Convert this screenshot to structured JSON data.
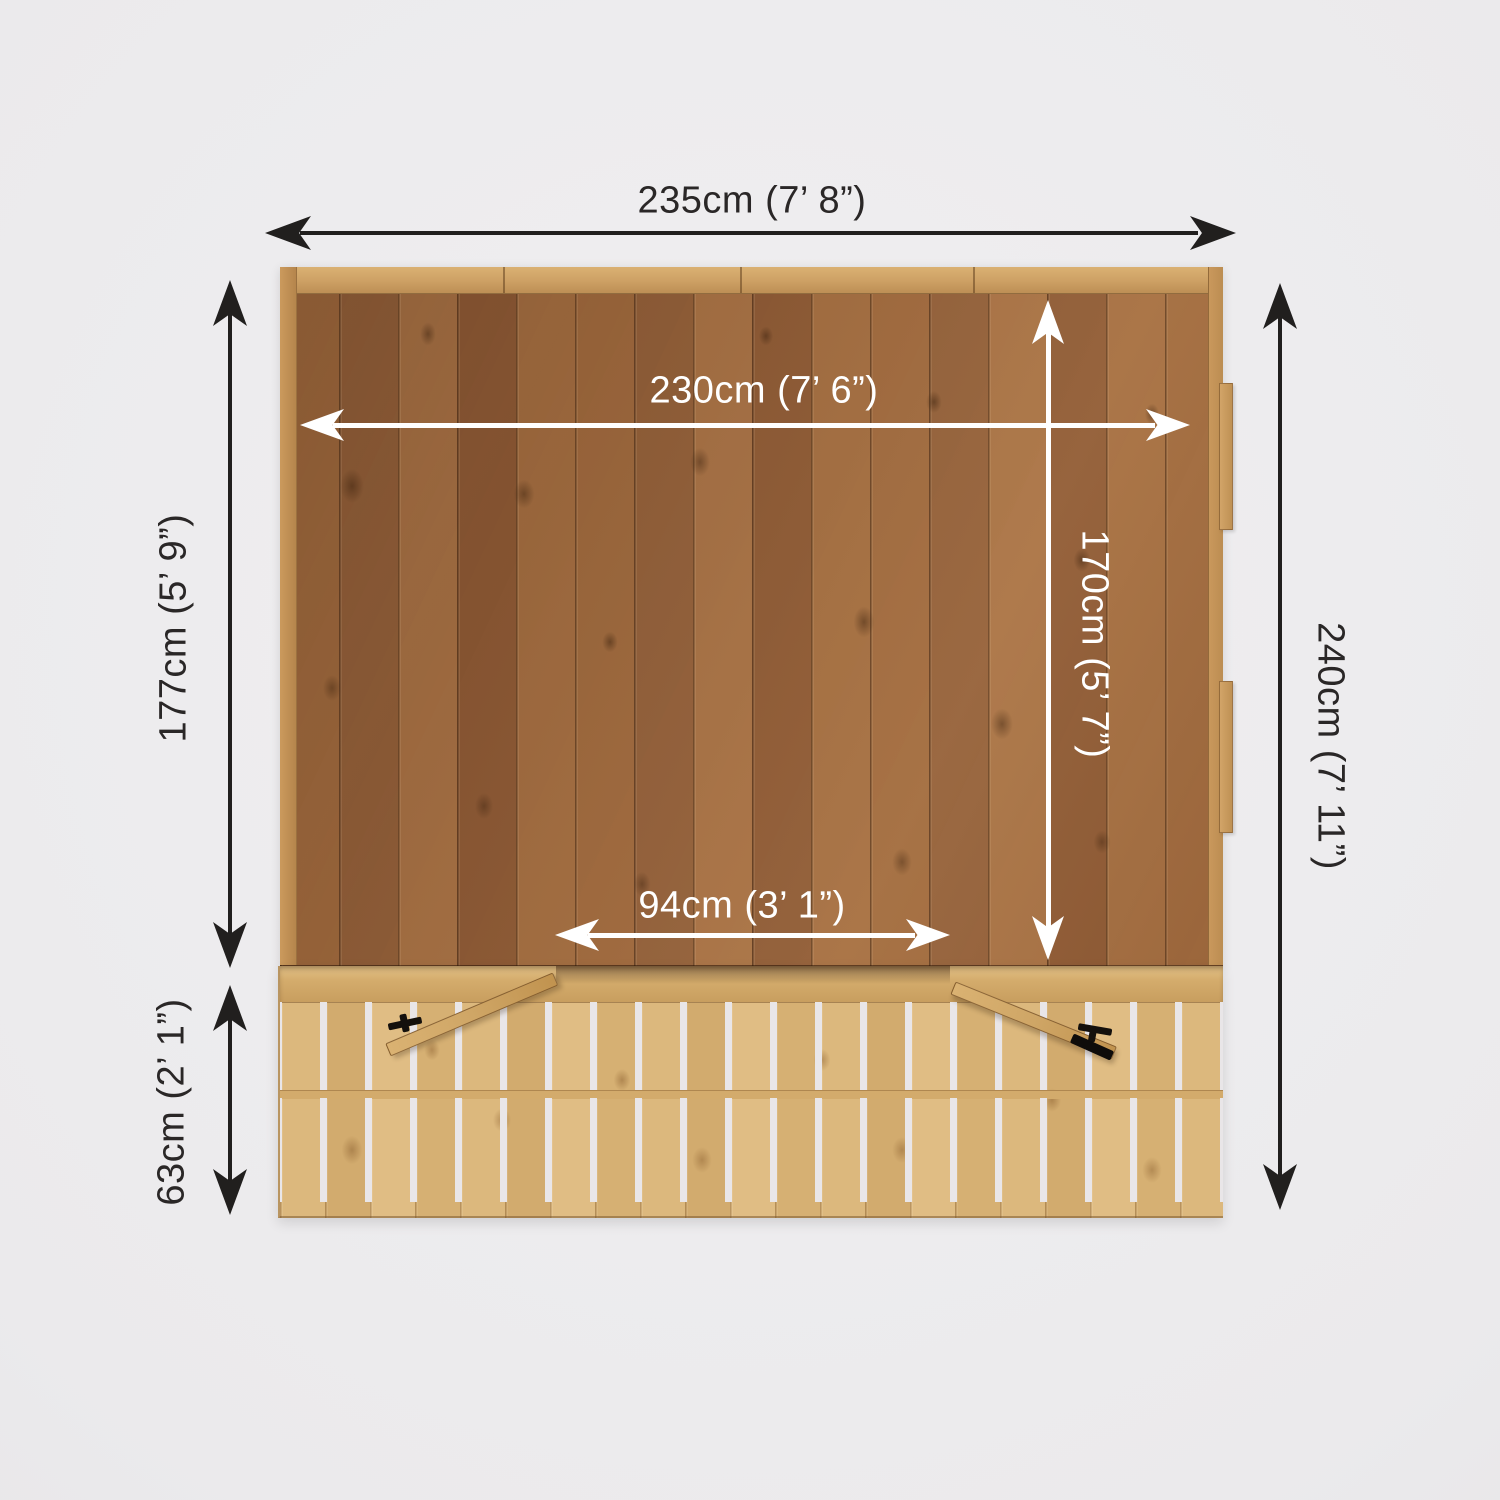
{
  "labels": {
    "overall_width": "235cm (7’ 8”)",
    "internal_width": "230cm (7’ 6”)",
    "internal_depth": "170cm (5’ 7”)",
    "door_opening_width": "94cm (3’ 1”)",
    "main_section_depth": "177cm (5’ 9”)",
    "veranda_depth": "63cm (2’ 1”)",
    "overall_depth": "240cm (7’ 11”)"
  },
  "colors": {
    "background": "#ebeaec",
    "dimension_dark": "#211f1e",
    "dimension_light": "#ffffff",
    "roof_wood": "#9c663a",
    "trim_wood": "#cda064",
    "deck_wood": "#d8b478",
    "door_handle": "#14100c"
  }
}
